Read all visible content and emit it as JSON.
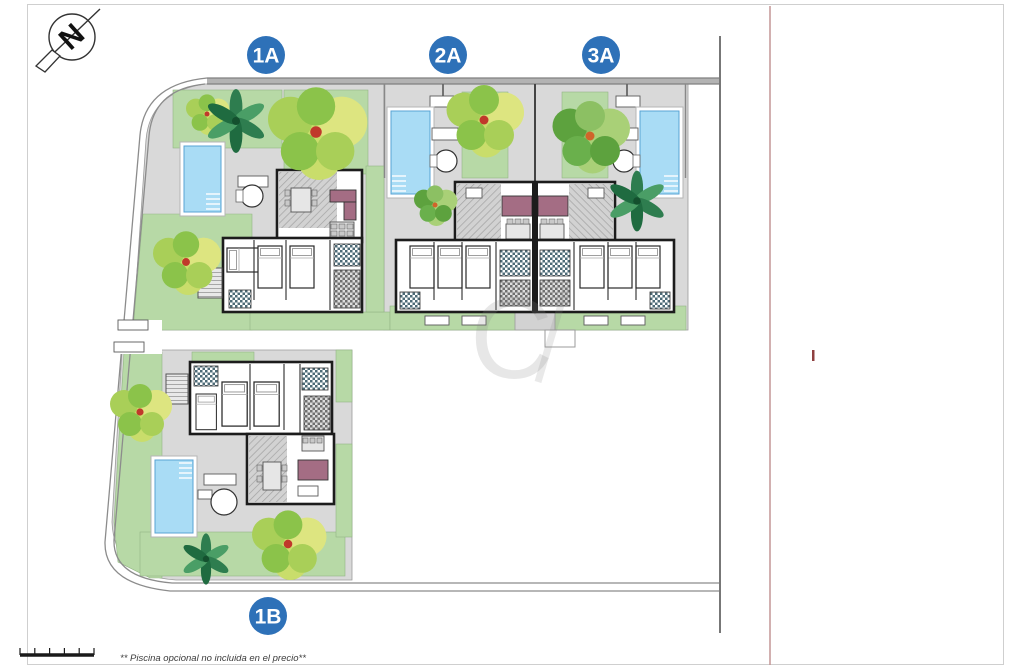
{
  "units": [
    {
      "id": "1A",
      "label": "1A"
    },
    {
      "id": "2A",
      "label": "2A"
    },
    {
      "id": "3A",
      "label": "3A"
    },
    {
      "id": "1B",
      "label": "1B"
    }
  ],
  "compass": {
    "letter": "N"
  },
  "watermark": {
    "letter": "C"
  },
  "footer": {
    "note": "** Piscina opcional no incluida en el precio**"
  },
  "colors": {
    "badge_blue": "#2e71b8",
    "garden_green": "#b7d9a6",
    "pool_blue": "#a9dcf5",
    "sofa_plum": "#a46d84",
    "boundary_red": "#c49696",
    "boundary_red_dark": "#8f4040",
    "wall_dark": "#1c1c1c"
  }
}
